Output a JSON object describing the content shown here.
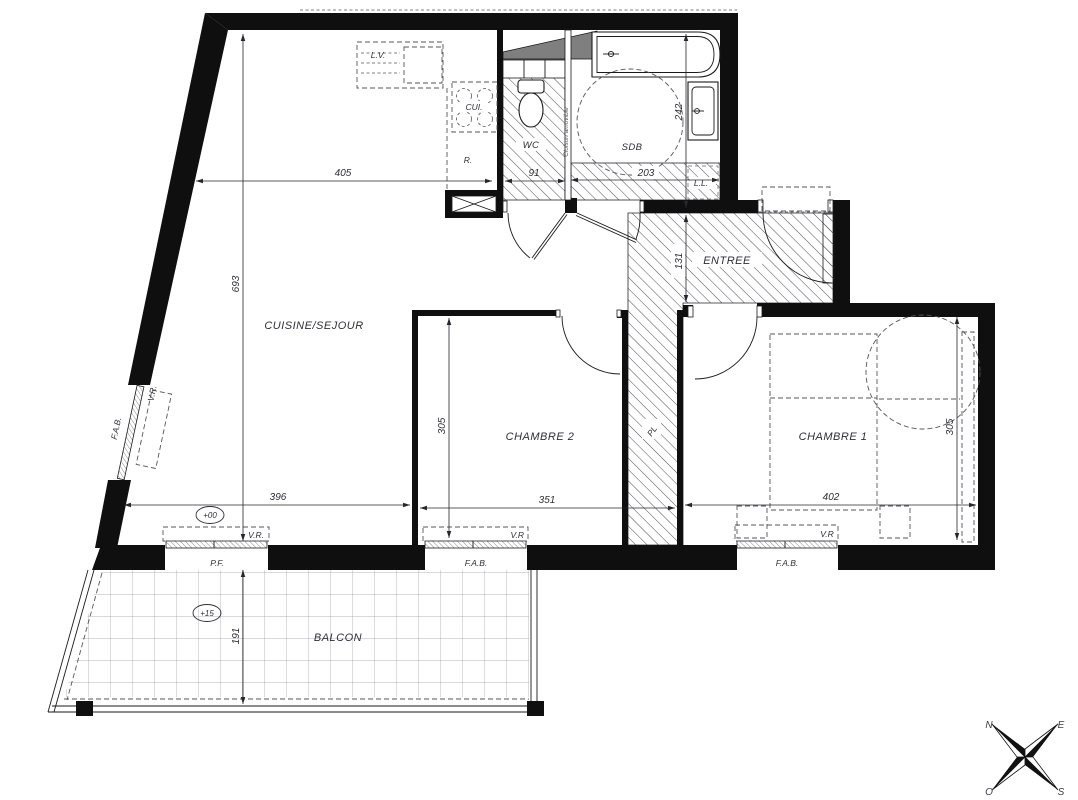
{
  "plan": {
    "rooms": {
      "sejour": "CUISINE/SEJOUR",
      "wc": "WC",
      "sdb": "SDB",
      "entree": "ENTREE",
      "chambre2": "CHAMBRE 2",
      "chambre1": "CHAMBRE 1",
      "balcon": "BALCON",
      "pl": "PL"
    },
    "fixtures": {
      "lv": "L.V.",
      "cui": "CUI.",
      "r": "R.",
      "ll": "L.L.",
      "cloison": "Cloison amovible"
    },
    "windows": {
      "fab_left": "F.A.B.",
      "vr_left": "V.R.",
      "pf": "P.F.",
      "vr_sejour": "V.R.",
      "fab_ch2": "F.A.B.",
      "vr_ch2": "V.R",
      "fab_ch1": "F.A.B.",
      "vr_ch1": "V.R"
    },
    "dims": {
      "sejour_w": "405",
      "wc_w": "91",
      "sdb_w": "203",
      "sdb_d": "242",
      "sejour_d": "693",
      "entree_d": "131",
      "ch2_d": "305",
      "ch2_w": "351",
      "ch1_w": "402",
      "ch1_d": "305",
      "sejour_w_bottom": "396",
      "balcon_d": "191"
    },
    "levels": {
      "main": "+00",
      "balcony": "+15"
    },
    "compass": {
      "n": "N",
      "e": "E",
      "s": "S",
      "o": "O"
    }
  }
}
